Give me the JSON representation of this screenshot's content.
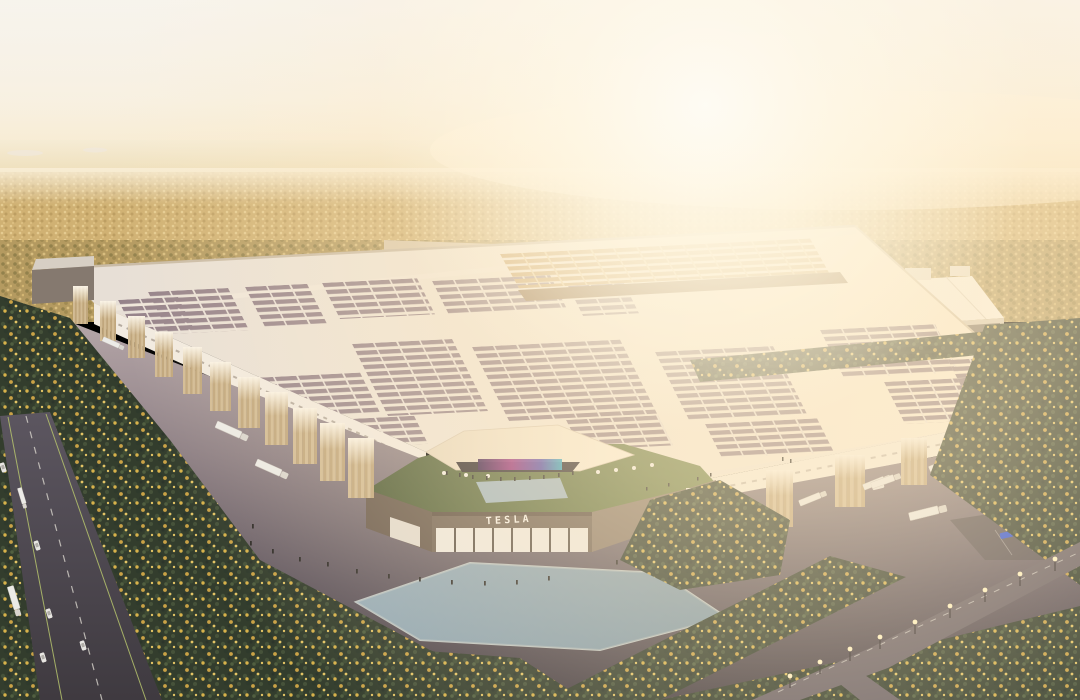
{
  "scene": {
    "title": "Aerial rendering of a Tesla Gigafactory in a pine forest at sunrise",
    "wordmark": "TESLA",
    "elements": [
      "sun-glare-sky",
      "distant-plain",
      "pine-forest-autumn-gold",
      "main-factory-solar-roof",
      "loading-dock-towers",
      "semi-trucks",
      "entrance-pavilion-green-roof",
      "media-screen",
      "plaza-pond",
      "roof-pond",
      "highway-with-traffic",
      "access-road-street-lamps",
      "parking-lot-cars",
      "pedestrians"
    ]
  },
  "colors": {
    "sky_top": "#f2efe9",
    "sky_horizon": "#f7e8c8",
    "sun_glow": "#fff7e2",
    "distant_plain": "#f0e3c4",
    "forest_far": "#d0b173",
    "forest_near": "#333d2d",
    "forest_gold": "#d7b24b",
    "factory_roof": "#efe6da",
    "solar_panel": "#95828a",
    "solar_panel_sunlit": "#c59d60",
    "dock_tower": "#c9b08a",
    "facade_white": "#f2ebe1",
    "entrance_facade": "#746557",
    "entrance_glass": "#eee9e0",
    "green_roof": "#68754a",
    "pond": "#89a0ad",
    "roof_pond": "#a2b6bf",
    "media_screen_magenta": "#9c3180",
    "media_screen_teal": "#35aac2",
    "concrete": "#a99b9e",
    "asphalt_dark": "#4e4449",
    "highway": "#565057",
    "lane_marking": "#d8d4cc",
    "edge_line": "#b6c46d",
    "truck": "#ecebe7",
    "car_red": "#b23229",
    "car_blue": "#2b4fd8",
    "lamp_light": "#fff3c4"
  }
}
